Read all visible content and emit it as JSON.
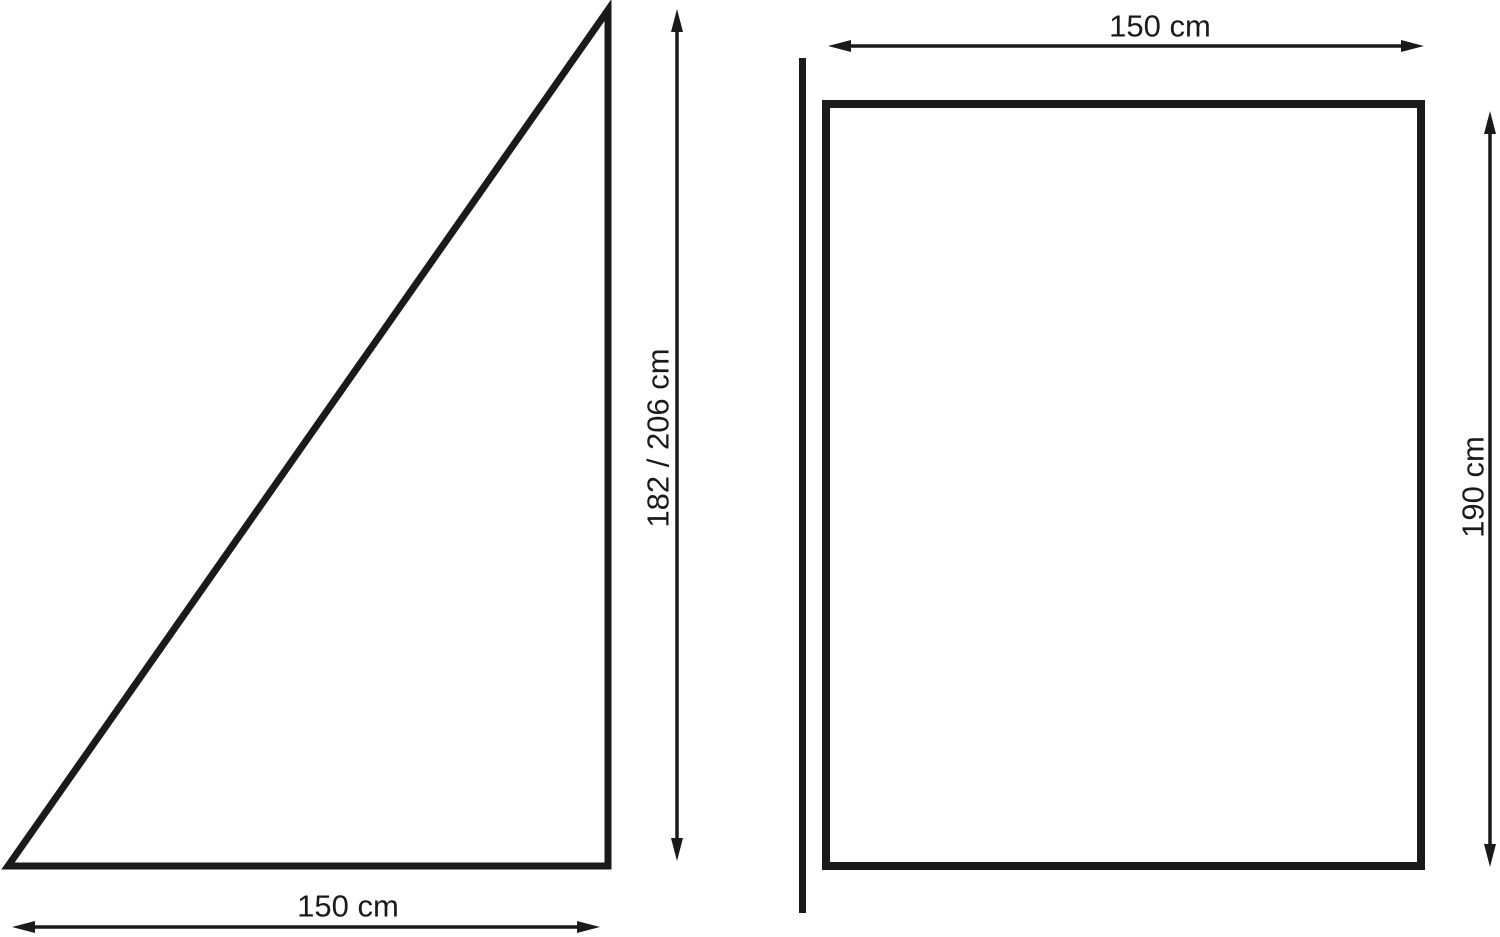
{
  "colors": {
    "line": "#1a1a1a",
    "background": "#ffffff"
  },
  "labels": {
    "triangle_width": "150 cm",
    "triangle_height": "182 / 206 cm",
    "rectangle_width": "150 cm",
    "rectangle_height": "190 cm"
  }
}
